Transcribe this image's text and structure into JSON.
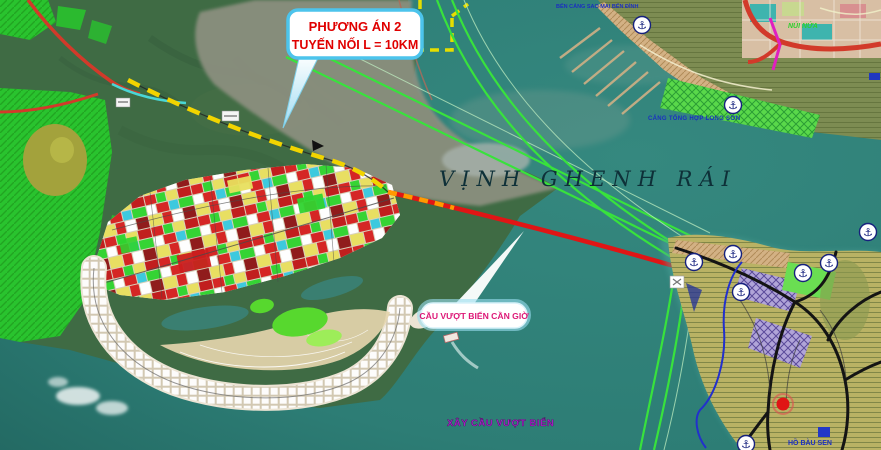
{
  "map": {
    "region_label": {
      "bay": "VỊNH GHENH RÁI"
    },
    "callout_option": {
      "line1": "PHƯƠNG ÁN 2",
      "line2": "TUYẾN NỐI L = 10KM"
    },
    "callout_bridge": {
      "label": "CẦU VƯỢT BIỂN CẦN GIỜ"
    },
    "note_bridge": "XÂY CẦU VƯỢT BIỂN",
    "labels": {
      "port_top": "BẾN CẢNG SAO MAI BẾN ĐÌNH",
      "port_general": "CẢNG TỔNG HỢP LONG SƠN",
      "mountain": "NÚI NỨA",
      "lake": "HỒ BÀU SEN"
    },
    "icons": {
      "anchor_glyph": "⚓"
    },
    "colors": {
      "sea": "#2f7f77",
      "forest": "#3f6b44",
      "mangrove": "#29c32e",
      "mudflat": "#8d9080",
      "urban-base": "#ece4d4",
      "route-red": "#e01515",
      "route-yellow": "#f2d400",
      "route-orange": "#ff9a00",
      "channel-green": "#38e23c",
      "callout-border": "#4cc4ec",
      "callout-text": "#e00000",
      "bridge-callout-text": "#dd1877",
      "note-purple": "#b01ed0",
      "bay-text": "#0e3038",
      "anchor-blue": "#16217d",
      "port-text": "#1b2fc0",
      "mountain-green": "#2ed02e",
      "road-red": "#d23a2a",
      "magenta-road": "#e020c0"
    }
  }
}
